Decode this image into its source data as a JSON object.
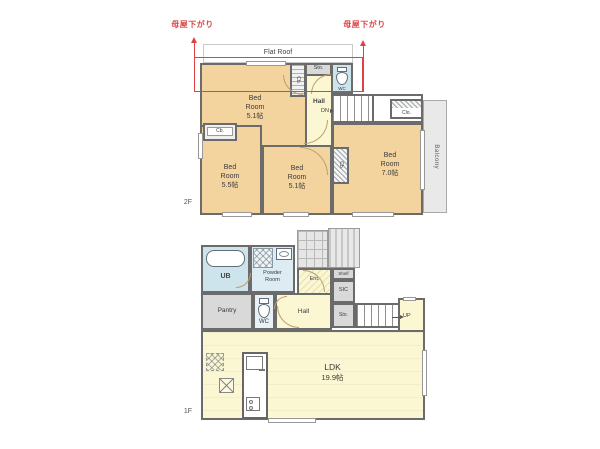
{
  "annotations": {
    "roof_note_left": "母屋下がり",
    "roof_note_right": "母屋下がり",
    "flat_roof": "Flat Roof"
  },
  "floor2": {
    "floor_label": "2F",
    "bedroom_top": {
      "l1": "Bed",
      "l2": "Room",
      "size": "5.1帖"
    },
    "bedroom_left": {
      "l1": "Bed",
      "l2": "Room",
      "size": "5.5帖"
    },
    "bedroom_mid": {
      "l1": "Bed",
      "l2": "Room",
      "size": "5.1帖"
    },
    "bedroom_right": {
      "l1": "Bed",
      "l2": "Room",
      "size": "7.0帖"
    },
    "hall": "Hall",
    "down": "DN",
    "wc": "WC",
    "sto": "Sto.",
    "cb_top": "Cb.",
    "cb_left": "Cb.",
    "cb_mid": "Cb.",
    "clo": "Clo.",
    "balcony": "Balcony"
  },
  "floor1": {
    "floor_label": "1F",
    "ub": "UB",
    "powder": {
      "l1": "Powder",
      "l2": "Room"
    },
    "pantry": "Pantry",
    "wc": "WC",
    "hall": "Hall",
    "ent": "Ent.",
    "shelf": "Shelf",
    "sic": "SIC",
    "sto": "Sto.",
    "up": "UP",
    "ldk": {
      "name": "LDK",
      "size": "19.9帖"
    }
  },
  "colors": {
    "wall": "#6b6b6b",
    "room_tan": "#f4d49e",
    "room_yellow": "#fbf7d2",
    "room_blue": "#cde4ed",
    "room_gray": "#d9d9d9",
    "balcony_gray": "#e9e9e9",
    "roof_red": "#dd4343"
  }
}
